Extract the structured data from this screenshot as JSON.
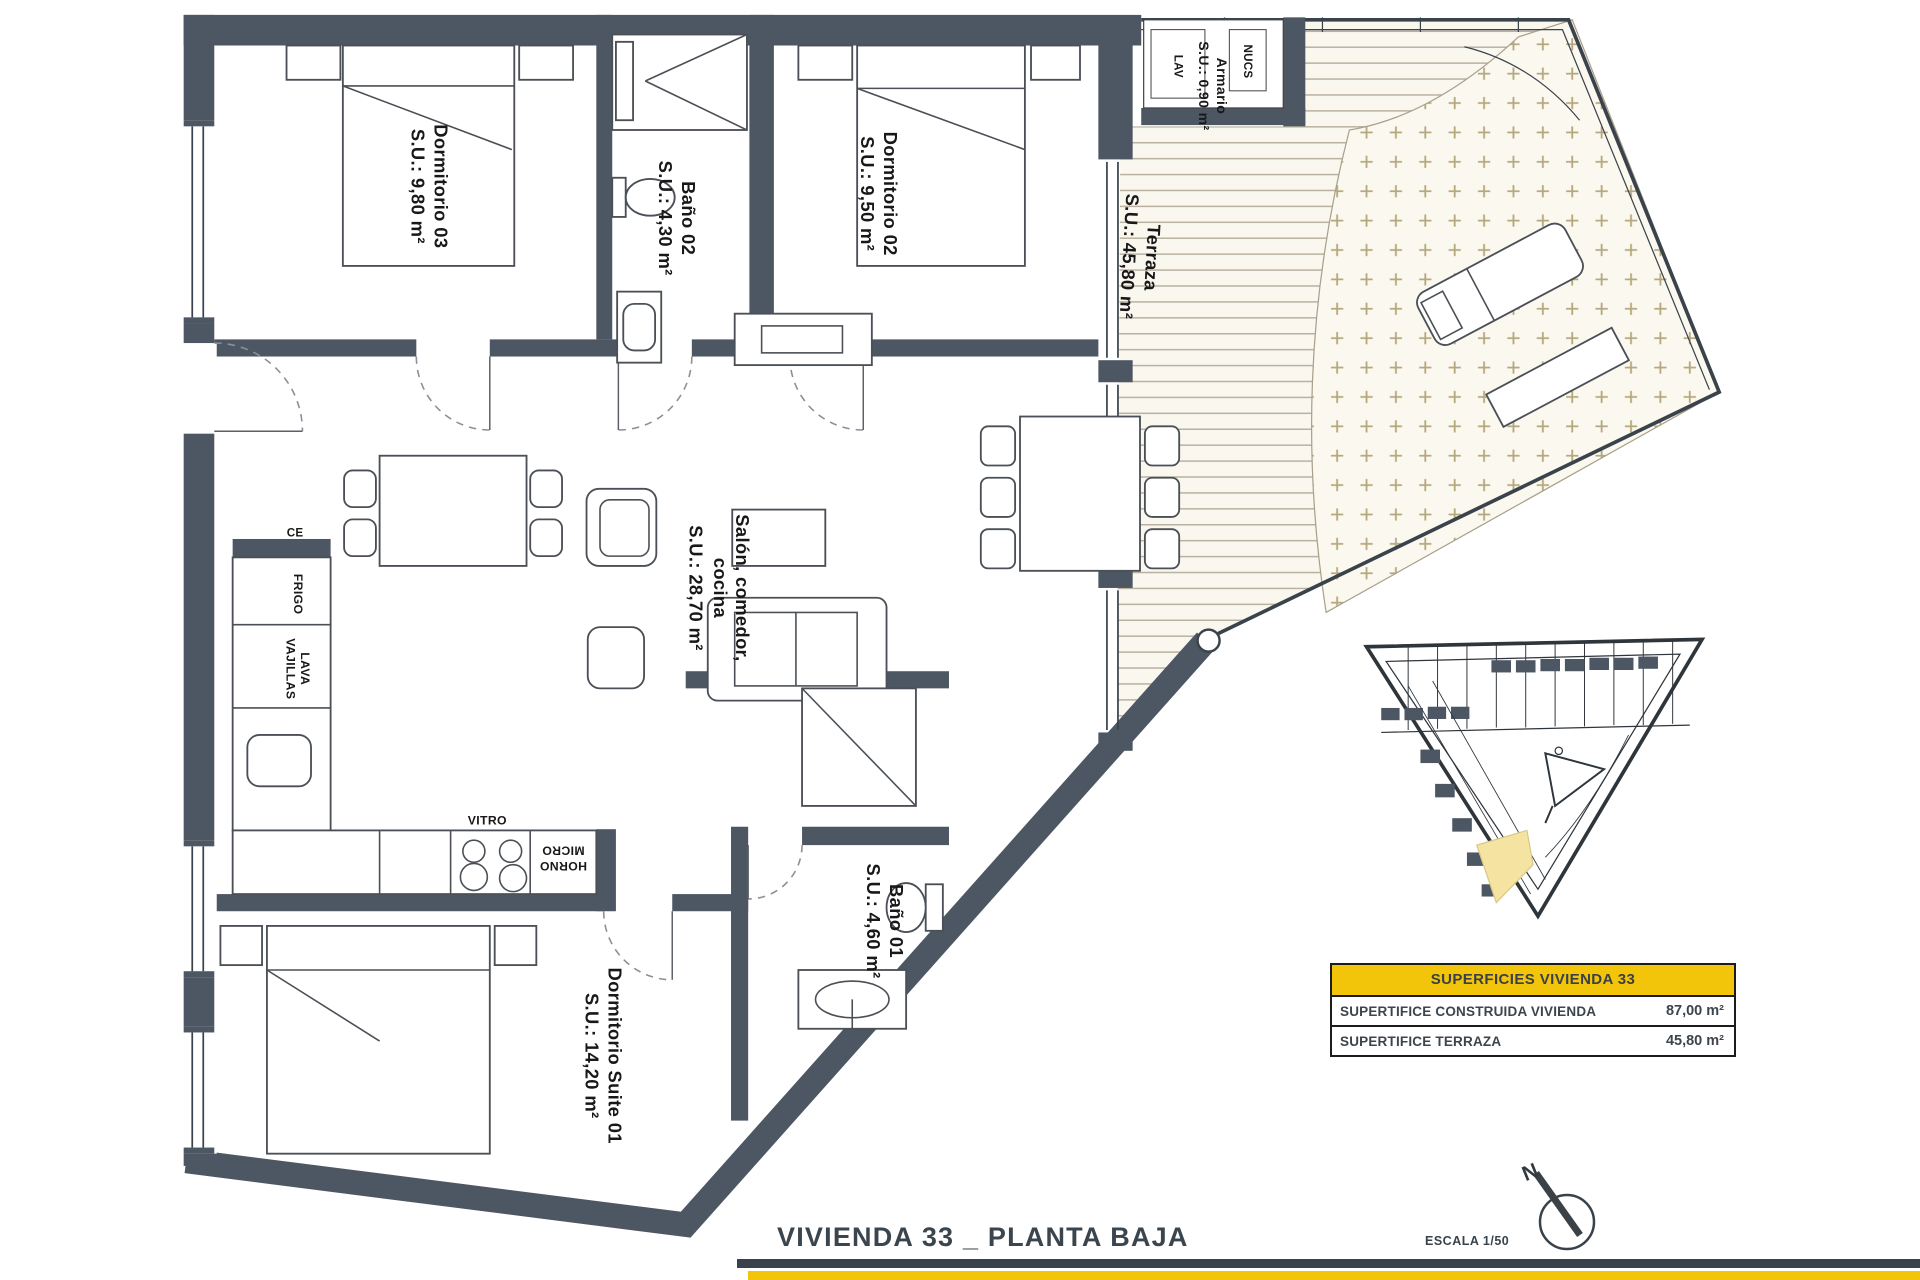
{
  "colors": {
    "wall": "#4d5763",
    "accent_yellow": "#F3C50A",
    "site_highlight": "#F5E3A1",
    "deck_line": "#b9b1a1"
  },
  "rooms": {
    "dorm03": {
      "name": "Dormitorio 03",
      "su": "S.U.: 9,80 m²"
    },
    "bano02": {
      "name": "Baño 02",
      "su": "S.U.: 4,30 m²"
    },
    "dorm02": {
      "name": "Dormitorio 02",
      "su": "S.U.: 9,50 m²"
    },
    "armario": {
      "name": "Armario",
      "su": "S.U.: 0,90 m²"
    },
    "terraza": {
      "name": "Terraza",
      "su": "S.U.: 45,80 m²"
    },
    "salon": {
      "name_line1": "Salón, comedor,",
      "name_line2": "cocina",
      "su": "S.U.: 28,70 m²"
    },
    "bano01": {
      "name": "Baño 01",
      "su": "S.U.: 4,60 m²"
    },
    "suite": {
      "name": "Dormitorio Suite 01",
      "su": "S.U.: 14,20 m²"
    }
  },
  "kitchen": {
    "frigo": "FRIGO",
    "lava_line1": "LAVA",
    "lava_line2": "VAJILLAS",
    "vitro": "VITRO",
    "horno": "HORNO",
    "micro": "MICRO",
    "ce": "CE"
  },
  "closet": {
    "lav": "LAV",
    "nucs": "NUCS"
  },
  "summary_table": {
    "header": "SUPERFICIES VIVIENDA 33",
    "rows": [
      {
        "label": "SUPERTIFICE CONSTRUIDA VIVIENDA",
        "value": "87,00 m²"
      },
      {
        "label": "SUPERTIFICE TERRAZA",
        "value": "45,80 m²"
      }
    ]
  },
  "footer": {
    "title": "VIVIENDA 33 _ PLANTA BAJA",
    "scale": "ESCALA 1/50",
    "north": "N"
  }
}
